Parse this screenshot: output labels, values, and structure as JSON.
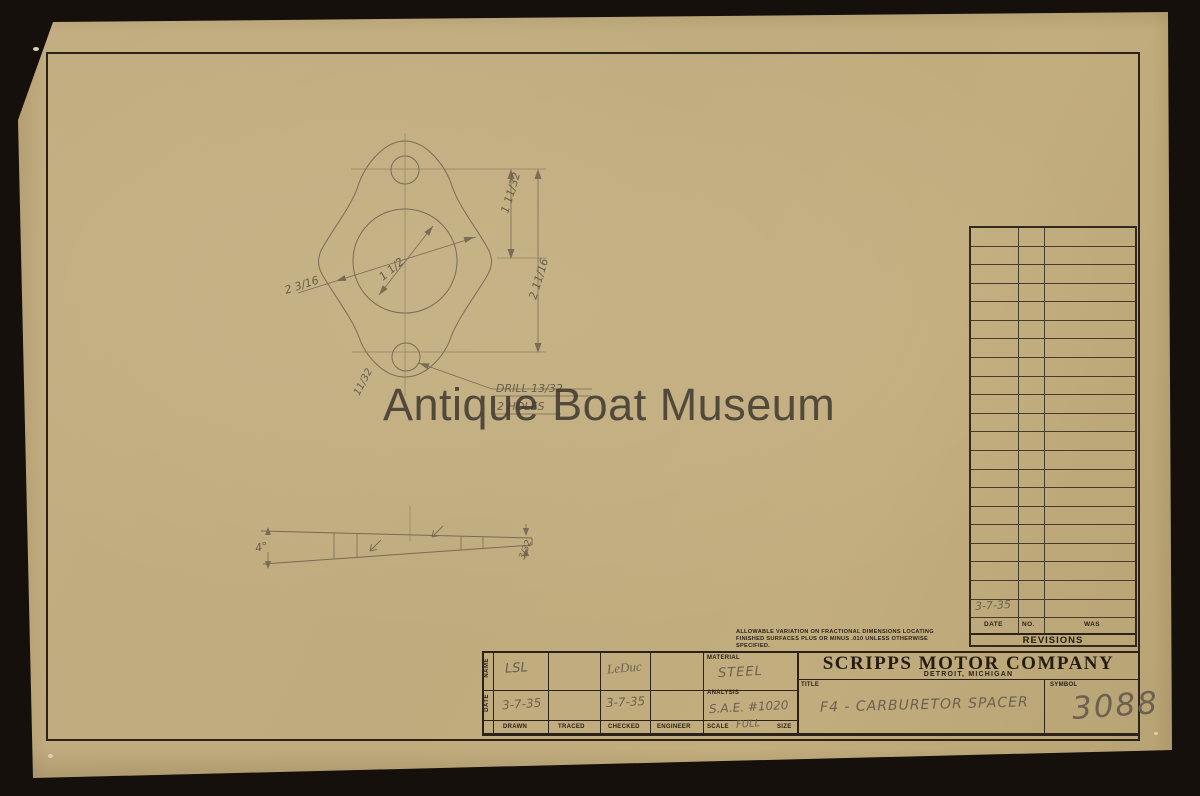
{
  "watermark": {
    "text": "Antique Boat Museum"
  },
  "front_view": {
    "dim_center_to_hole": "1 11/32",
    "dim_hole_spacing": "2 11/16",
    "dim_bolt_circle": "2 3/16",
    "dim_bore": "1 1/2",
    "dim_thickness": "11/32",
    "drill_note_line1": "DRILL 13/32",
    "drill_note_line2": "2 HOLES"
  },
  "side_view": {
    "angle": "4°",
    "thin_end_thickness": "3/32"
  },
  "revisions_table": {
    "heading": "REVISIONS",
    "columns": [
      "DATE",
      "NO.",
      "WAS"
    ],
    "empty_row_count": 21,
    "last_entry_date": "3-7-35"
  },
  "tolerance_note": {
    "line1": "ALLOWABLE VARIATION ON FRACTIONAL DIMENSIONS LOCATING",
    "line2": "FINISHED SURFACES PLUS OR MINUS .010 UNLESS OTHERWISE",
    "line3": "SPECIFIED."
  },
  "title_block": {
    "name_row_label": "NAME",
    "date_row_label": "DATE",
    "drawn_label": "DRAWN",
    "traced_label": "TRACED",
    "checked_label": "CHECKED",
    "engineer_label": "ENGINEER",
    "drawn_name": "LSL",
    "drawn_date": "3-7-35",
    "checked_name": "LeDuc",
    "checked_date": "3-7-35",
    "material_label": "MATERIAL",
    "material_value": "STEEL",
    "analysis_label": "ANALYSIS",
    "analysis_value": "S.A.E. #1020",
    "scale_label": "SCALE",
    "scale_value": "FULL",
    "size_label": "SIZE",
    "company_name": "SCRIPPS MOTOR COMPANY",
    "company_location": "DETROIT, MICHIGAN",
    "title_label": "TITLE",
    "title_value": "F4 - CARBURETOR SPACER",
    "symbol_label": "SYMBOL",
    "symbol_value": "3088"
  }
}
